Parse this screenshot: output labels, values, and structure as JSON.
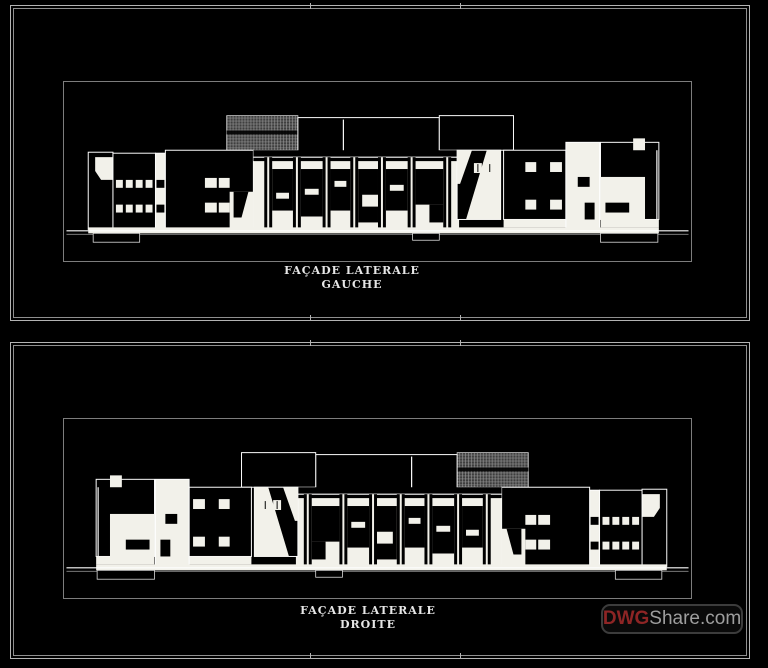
{
  "app": {
    "description": "CAD sheet with two building side elevations on black model-space background"
  },
  "panels": [
    {
      "id": "gauche",
      "title_line1": "FAÇADE LATERALE",
      "title_line2": "GAUCHE"
    },
    {
      "id": "droite",
      "title_line1": "FAÇADE LATERALE",
      "title_line2": "DROITE"
    }
  ],
  "watermark": {
    "dwg": "DWG",
    "share": "Share.com"
  },
  "colors": {
    "background": "#000000",
    "frame_line": "#b3b3b3",
    "frame_line_inner": "#8f8f8f",
    "viewport_line": "#7d7d7d",
    "drawing_stroke": "#fdfdfd",
    "drawing_fill": "#f2f1ea",
    "hatch_base": "#3e3e3e",
    "hatch_grid": "#9a9a9a",
    "label_text": "#e6e6e6",
    "watermark_border": "#3c3c3c",
    "watermark_dwg": "#8e2525",
    "watermark_share": "#9e9e9e"
  }
}
